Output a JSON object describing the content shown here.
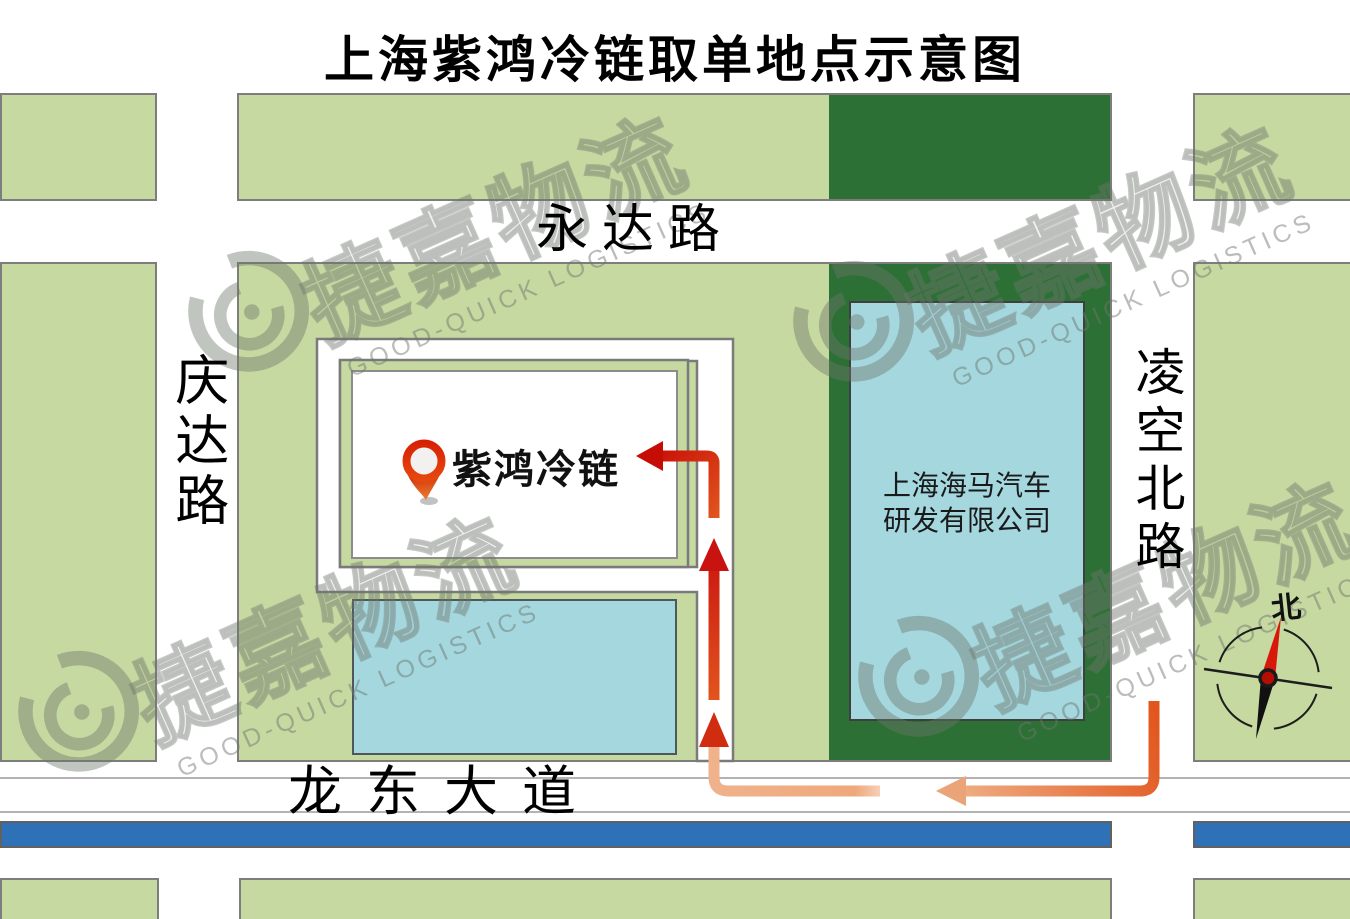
{
  "title": "上海紫鸿冷链取单地点示意图",
  "roads": {
    "north": "永达路",
    "west": "庆达路",
    "east": "凌空北路",
    "south": "龙东大道"
  },
  "pickup": {
    "label": "紫鸿冷链"
  },
  "haima_building": {
    "line1": "上海海马汽车",
    "line2": "研发有限公司"
  },
  "compass": {
    "north_label": "北"
  },
  "watermark": {
    "cn": "捷嘉物流",
    "en": "GOOD-QUICK LOGISTICS"
  },
  "colors": {
    "green-light": "#c5d9a1",
    "green-dark": "#2d7036",
    "blue-building": "#a4d7de",
    "blue-bar": "#2f71b7",
    "border-gray": "#7d7d7d",
    "lane-line": "#b3b3b3",
    "arrow-red": "#c81310",
    "arrow-orange": "#e2561d",
    "arrow-salmon": "#efab81",
    "pin-red": "#d2270a",
    "watermark": "#6e766c"
  }
}
